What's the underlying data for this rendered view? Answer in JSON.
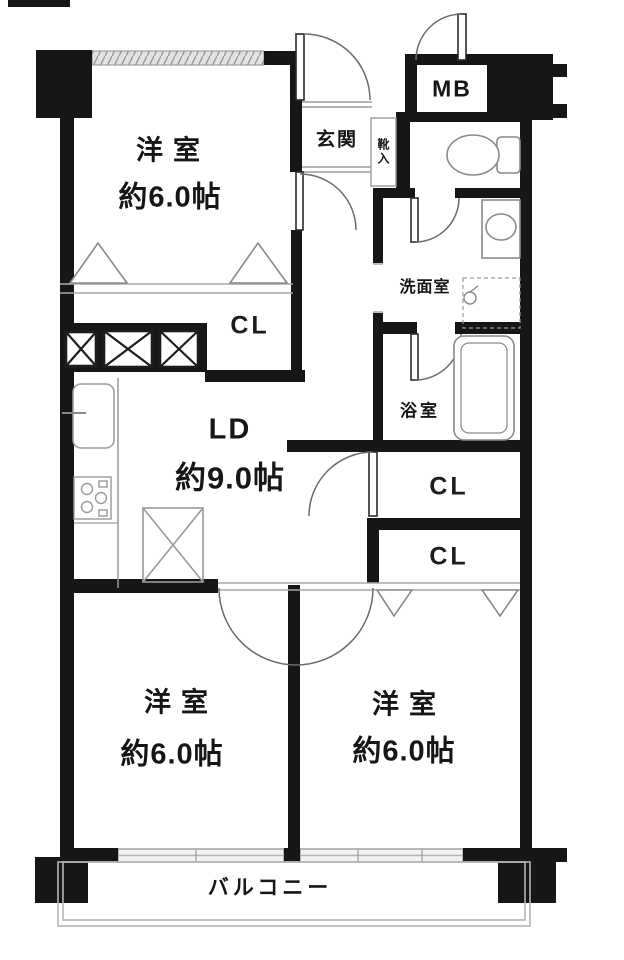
{
  "floorplan": {
    "title": "2LDK apartment floor plan",
    "rooms": {
      "bedroom_top_left": {
        "name": "洋室",
        "size": "約6.0帖"
      },
      "bedroom_bottom_left": {
        "name": "洋室",
        "size": "約6.0帖"
      },
      "bedroom_bottom_right": {
        "name": "洋室",
        "size": "約6.0帖"
      },
      "living_dining": {
        "name": "LD",
        "size": "約9.0帖"
      },
      "entrance": {
        "name": "玄関"
      },
      "shoe_cabinet": {
        "name": "靴入"
      },
      "meter_box": {
        "name": "MB"
      },
      "washroom": {
        "name": "洗面室"
      },
      "bathroom": {
        "name": "浴室"
      },
      "closet_top": {
        "name": "CL"
      },
      "closet_mid": {
        "name": "CL"
      },
      "closet_low": {
        "name": "CL"
      },
      "balcony": {
        "name": "バルコニー"
      }
    },
    "colors": {
      "wall": "#161616",
      "window": "#c3c3c3",
      "fixture_stroke": "#8a8a8a",
      "door_stroke": "#6b6b6b"
    }
  }
}
